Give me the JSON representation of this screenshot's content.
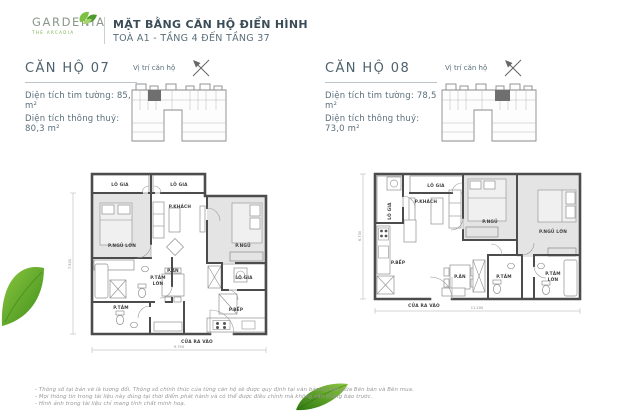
{
  "header": {
    "logo_name": "GARDENIA",
    "logo_tagline": "THE ARCADIA",
    "title": "MẶT BẰNG CĂN HỘ ĐIỂN HÌNH",
    "subtitle": "TOÀ A1 - TẦNG 4 ĐẾN TẦNG 37"
  },
  "apartments": [
    {
      "name": "CĂN HỘ 07",
      "info_lines": [
        "Diện tích tim tường: 85,7 m²",
        "Diện tích thông thuỷ: 80,3 m²"
      ],
      "location_label": "Vị trí căn hộ",
      "entrance_label": "CỬA RA VÀO",
      "dim_width": "9.750",
      "dim_height": "7.500",
      "rooms": {
        "loggia_top_left": "LÔ GIA",
        "loggia_top_right": "LÔ GIA",
        "living": "P.KHÁCH",
        "master_bedroom": "P.NGỦ LỚN",
        "bedroom": "P.NGỦ",
        "master_bath_line1": "P.TẮM",
        "master_bath_line2": "LỚN",
        "dining": "P.ĂN",
        "loggia_side": "LÔ GIA",
        "bath": "P.TẮM",
        "kitchen": "P.BẾP"
      }
    },
    {
      "name": "CĂN HỘ 08",
      "info_lines": [
        "Diện tích tim tường: 78,5 m²",
        "Diện tích thông thuỷ: 73,0 m²"
      ],
      "location_label": "Vị trí căn hộ",
      "entrance_label": "CỬA RA VÀO",
      "dim_width": "11.200",
      "dim_height": "6.700",
      "rooms": {
        "loggia_side": "LÔ GIA",
        "loggia_top": "LÔ GIA",
        "living": "P.KHÁCH",
        "bedroom": "P.NGỦ",
        "master_bedroom": "P.NGỦ LỚN",
        "kitchen": "P.BẾP",
        "dining": "P.ĂN",
        "bath": "P.TẮM",
        "master_bath_line1": "P.TẮM",
        "master_bath_line2": "LỚN"
      }
    }
  ],
  "footnotes": [
    "- Thông số tại bản vẽ là tương đối. Thông số chính thức của từng căn hộ sẽ được quy định tại văn bản ký kết giữa Bên bán và Bên mua.",
    "- Mọi thông tin trong tài liệu này đúng tại thời điểm phát hành và có thể được điều chỉnh mà không cần thông báo trước.",
    "- Hình ảnh trong tài liệu chỉ mang tính chất minh hoạ."
  ],
  "colors": {
    "brand_green": "#79b24a",
    "leaf_green_light": "#8cc63f",
    "leaf_green_dark": "#3e8f1c",
    "title_text": "#3b4d59",
    "wall_gray": "#4c4c4c",
    "bedroom_fill": "#e4e4e4",
    "unit_highlight": "#6f6f6f"
  }
}
